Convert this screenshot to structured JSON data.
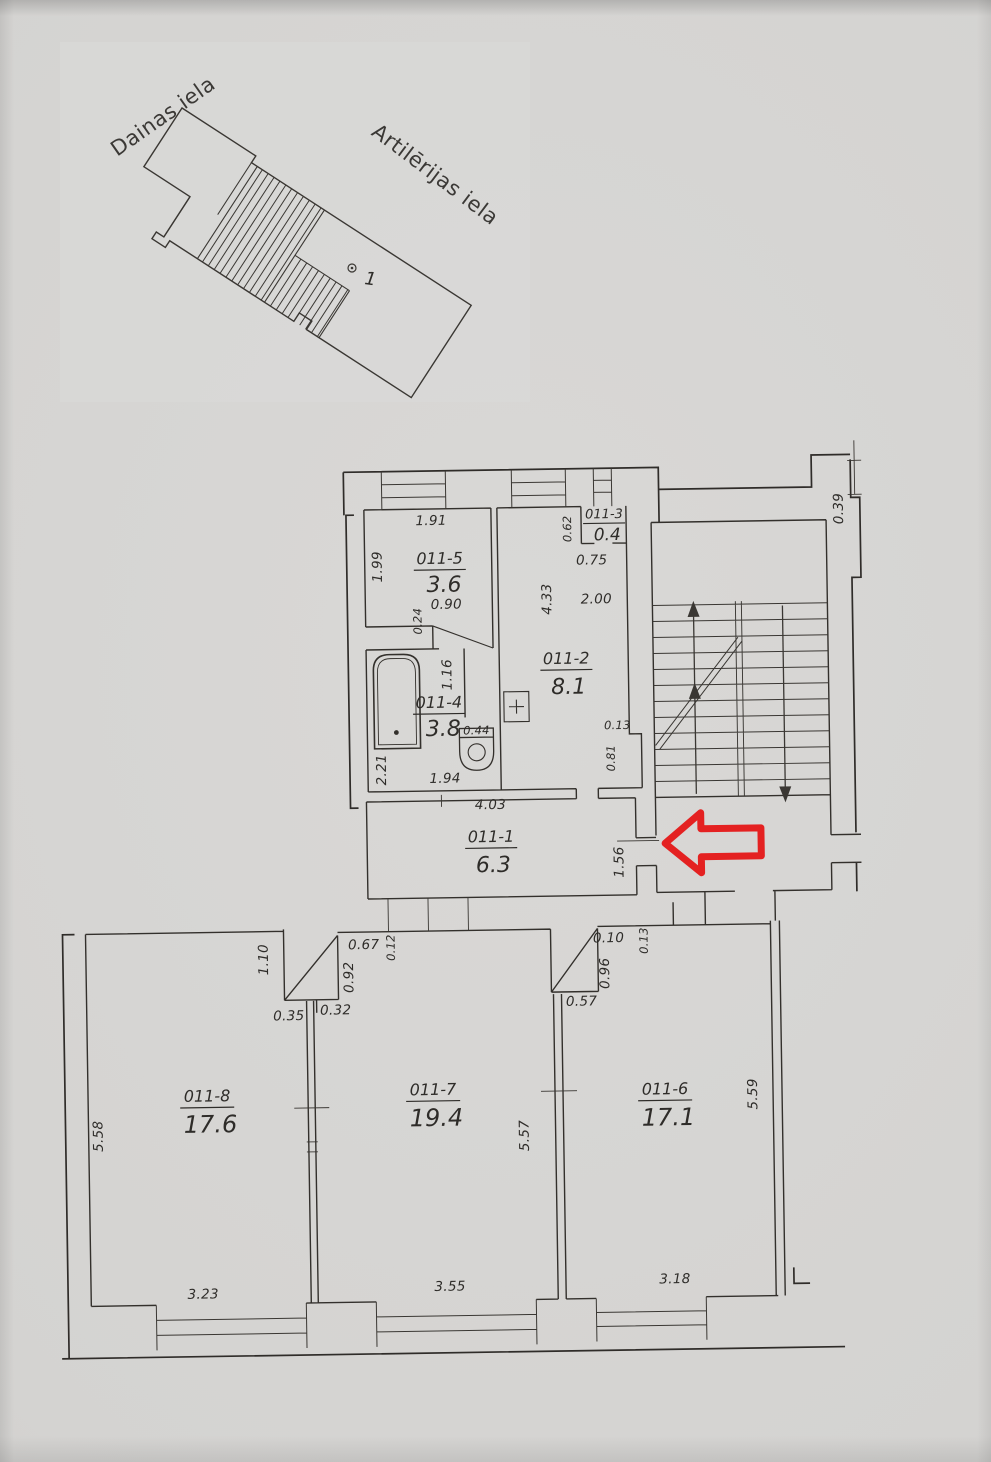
{
  "site_plan": {
    "street_left": "Dainas iela",
    "street_right": "Artilērijas iela",
    "building_marker": "1"
  },
  "floor_plan": {
    "rooms": {
      "r1": {
        "id": "011-1",
        "area": "6.3"
      },
      "r2": {
        "id": "011-2",
        "area": "8.1"
      },
      "r3": {
        "id": "011-3",
        "area": "0.4"
      },
      "r4": {
        "id": "011-4",
        "area": "3.8"
      },
      "r5": {
        "id": "011-5",
        "area": "3.6"
      },
      "r6": {
        "id": "011-6",
        "area": "17.1"
      },
      "r7": {
        "id": "011-7",
        "area": "19.4"
      },
      "r8": {
        "id": "011-8",
        "area": "17.6"
      }
    },
    "dims": {
      "room5_top": "1.91",
      "room5_left": "1.99",
      "room5_door": "0.90",
      "wall_left": "0.24",
      "room3_left": "0.62",
      "room3_bottom": "0.75",
      "room2_left": "4.33",
      "room2_width": "2.00",
      "room2_jog_width": "0.13",
      "room2_jog_height": "0.81",
      "bath_partition": "1.16",
      "bath_left": "2.21",
      "bath_bottom": "1.94",
      "toilet": "0.44",
      "hall_top": "4.03",
      "hall_right": "1.56",
      "stair_wall": "0.39",
      "door1_left": "1.10",
      "door1_top": "0.67",
      "door1_wall": "0.12",
      "door1_right": "0.92",
      "door1_bottom_left": "0.35",
      "door1_bottom": "0.32",
      "door2_top": "0.10",
      "door2_wall": "0.13",
      "door2_right": "0.96",
      "door2_bottom": "0.57",
      "room8_left": "5.58",
      "room8_bottom": "3.23",
      "room7_bottom": "3.55",
      "room7_right": "5.57",
      "room6_bottom": "3.18",
      "room6_right": "5.59"
    }
  },
  "colors": {
    "paper": "#d5d4d2",
    "ink": "#33302c",
    "arrow_red": "#e51717"
  }
}
